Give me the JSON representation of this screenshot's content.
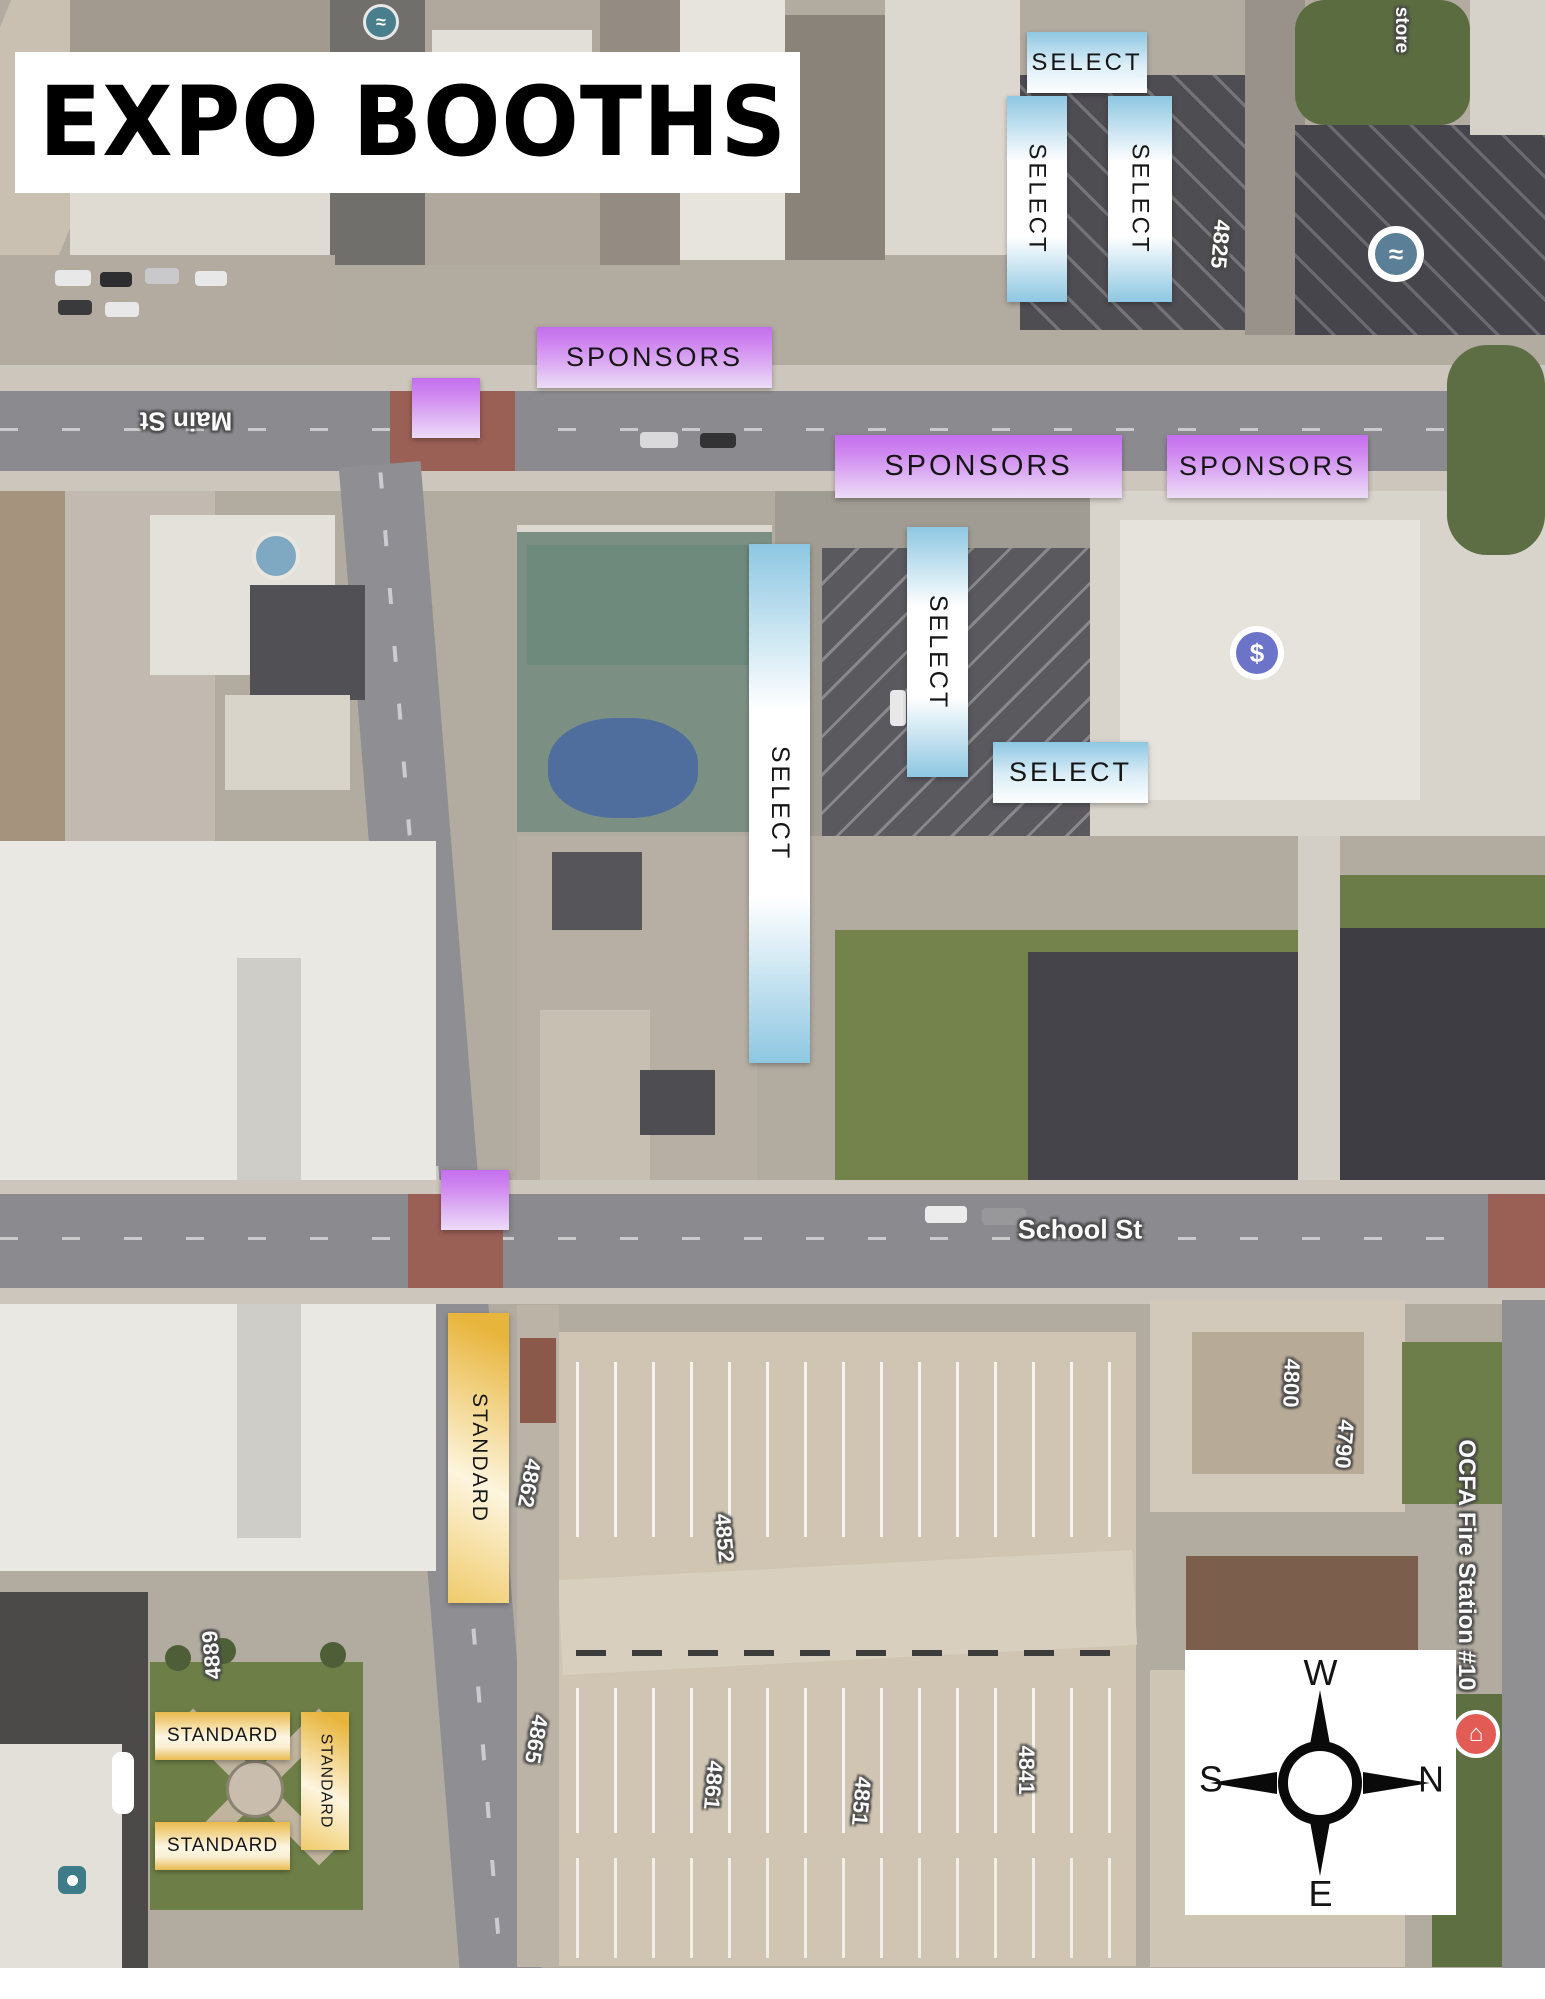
{
  "title": {
    "text": "EXPO BOOTHS"
  },
  "booths": {
    "colors": {
      "select_blue": "#8ec7e2",
      "sponsors_purple": "#c46fee",
      "standard_gold": "#e9b94a"
    },
    "select": [
      {
        "id": "select-top",
        "label": "SELECT",
        "orientation": "horizontal"
      },
      {
        "id": "select-top-left",
        "label": "SELECT",
        "orientation": "vertical"
      },
      {
        "id": "select-top-right",
        "label": "SELECT",
        "orientation": "vertical"
      },
      {
        "id": "select-middle",
        "label": "SELECT",
        "orientation": "vertical"
      },
      {
        "id": "select-long",
        "label": "SELECT",
        "orientation": "vertical"
      },
      {
        "id": "select-east",
        "label": "SELECT",
        "orientation": "horizontal"
      }
    ],
    "sponsors": [
      {
        "id": "sponsors-main-st",
        "label": "SPONSORS"
      },
      {
        "id": "sponsors-middle",
        "label": "SPONSORS"
      },
      {
        "id": "sponsors-right",
        "label": "SPONSORS"
      }
    ],
    "sponsor_squares": [
      {
        "id": "sponsors-square-main-st"
      },
      {
        "id": "sponsors-square-school-st"
      }
    ],
    "standard": [
      {
        "id": "standard-long",
        "label": "STANDARD",
        "orientation": "vertical"
      },
      {
        "id": "standard-park-top",
        "label": "STANDARD",
        "orientation": "horizontal"
      },
      {
        "id": "standard-park-side",
        "label": "STANDARD",
        "orientation": "vertical"
      },
      {
        "id": "standard-park-bottom",
        "label": "STANDARD",
        "orientation": "horizontal"
      }
    ]
  },
  "map": {
    "streets": [
      {
        "text": "Main St"
      },
      {
        "text": "School St"
      }
    ],
    "addresses": [
      "4825",
      "4800",
      "4790",
      "4862",
      "4865",
      "4852",
      "4861",
      "4851",
      "4841",
      "4889"
    ],
    "places": [
      {
        "text": "store"
      },
      {
        "text": "OCFA Fire Station #10"
      }
    ],
    "poi": {
      "dollar": "$",
      "wave": "≈",
      "station": "⌂"
    }
  },
  "compass": {
    "west": "W",
    "north": "N",
    "east": "E",
    "south": "S"
  }
}
